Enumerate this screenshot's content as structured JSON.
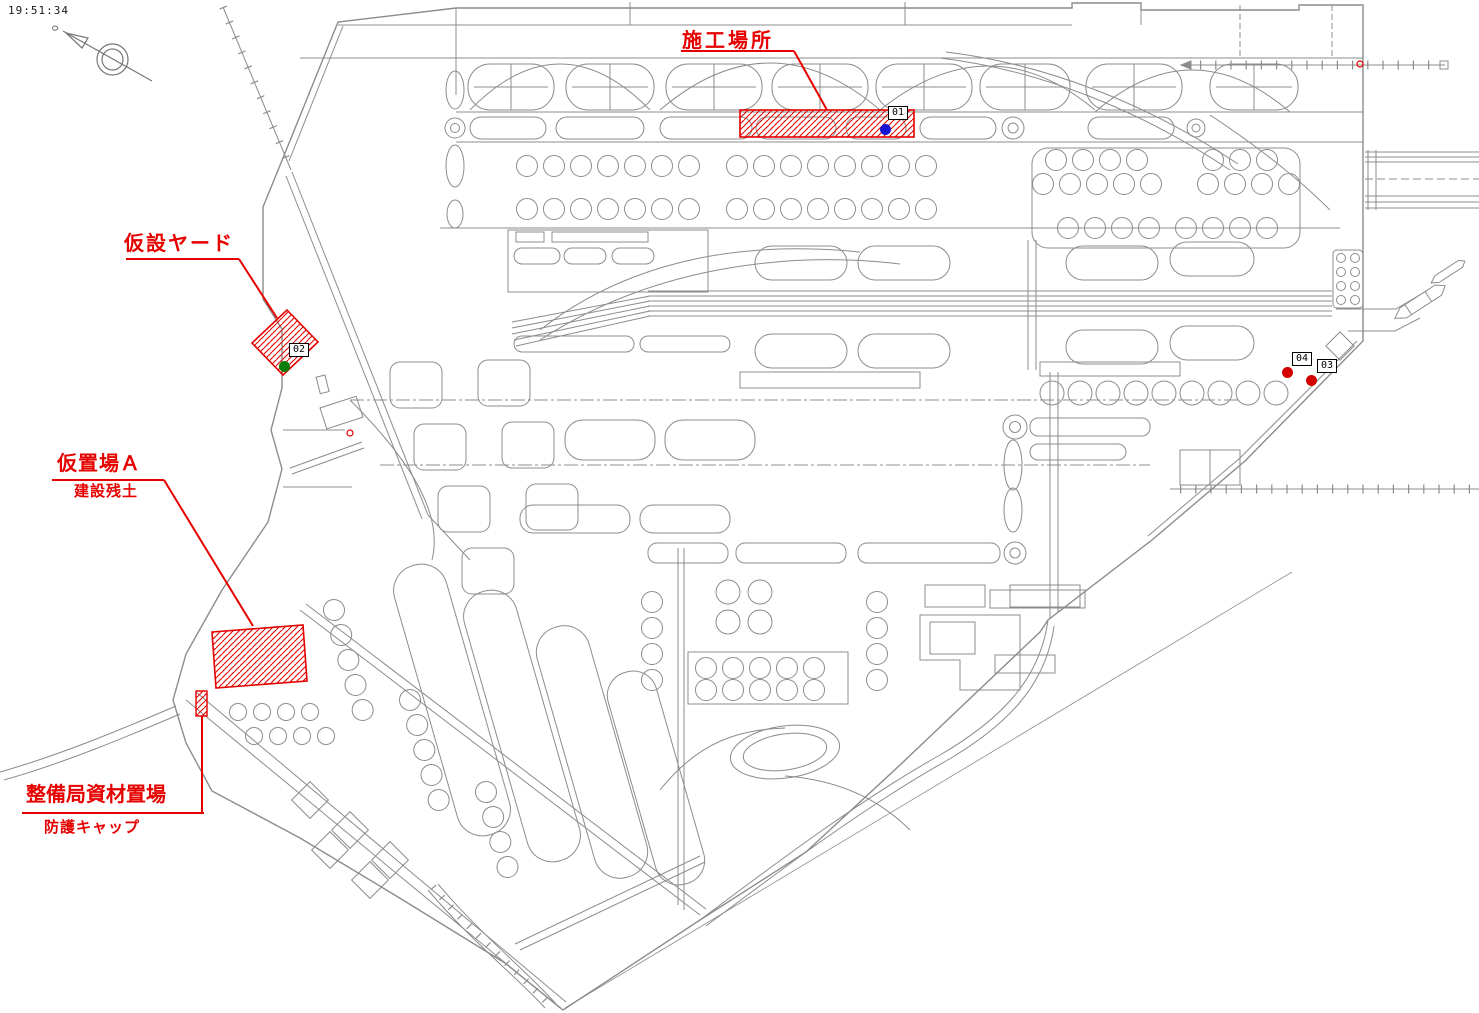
{
  "timestamp": "19:51:34",
  "annotations": {
    "construction_site": {
      "label": "施工場所"
    },
    "temporary_yard": {
      "label": "仮設ヤード"
    },
    "temporary_storage_a": {
      "label": "仮置場Ａ",
      "sublabel": "建設残土"
    },
    "maintenance_material_storage": {
      "label": "整備局資材置場",
      "sublabel": "防護キャップ"
    }
  },
  "markers": {
    "m01": {
      "id": "01",
      "dot_color": "#1414d2"
    },
    "m02": {
      "id": "02",
      "dot_color": "#0a7d0a"
    },
    "m03": {
      "id": "03",
      "dot_color": "#d40000"
    },
    "m04": {
      "id": "04",
      "dot_color": "#d40000"
    }
  },
  "colors": {
    "annotation_red": "#e60000",
    "drawing_gray": "#8c8c8c",
    "hatch_red": "#e60000"
  }
}
